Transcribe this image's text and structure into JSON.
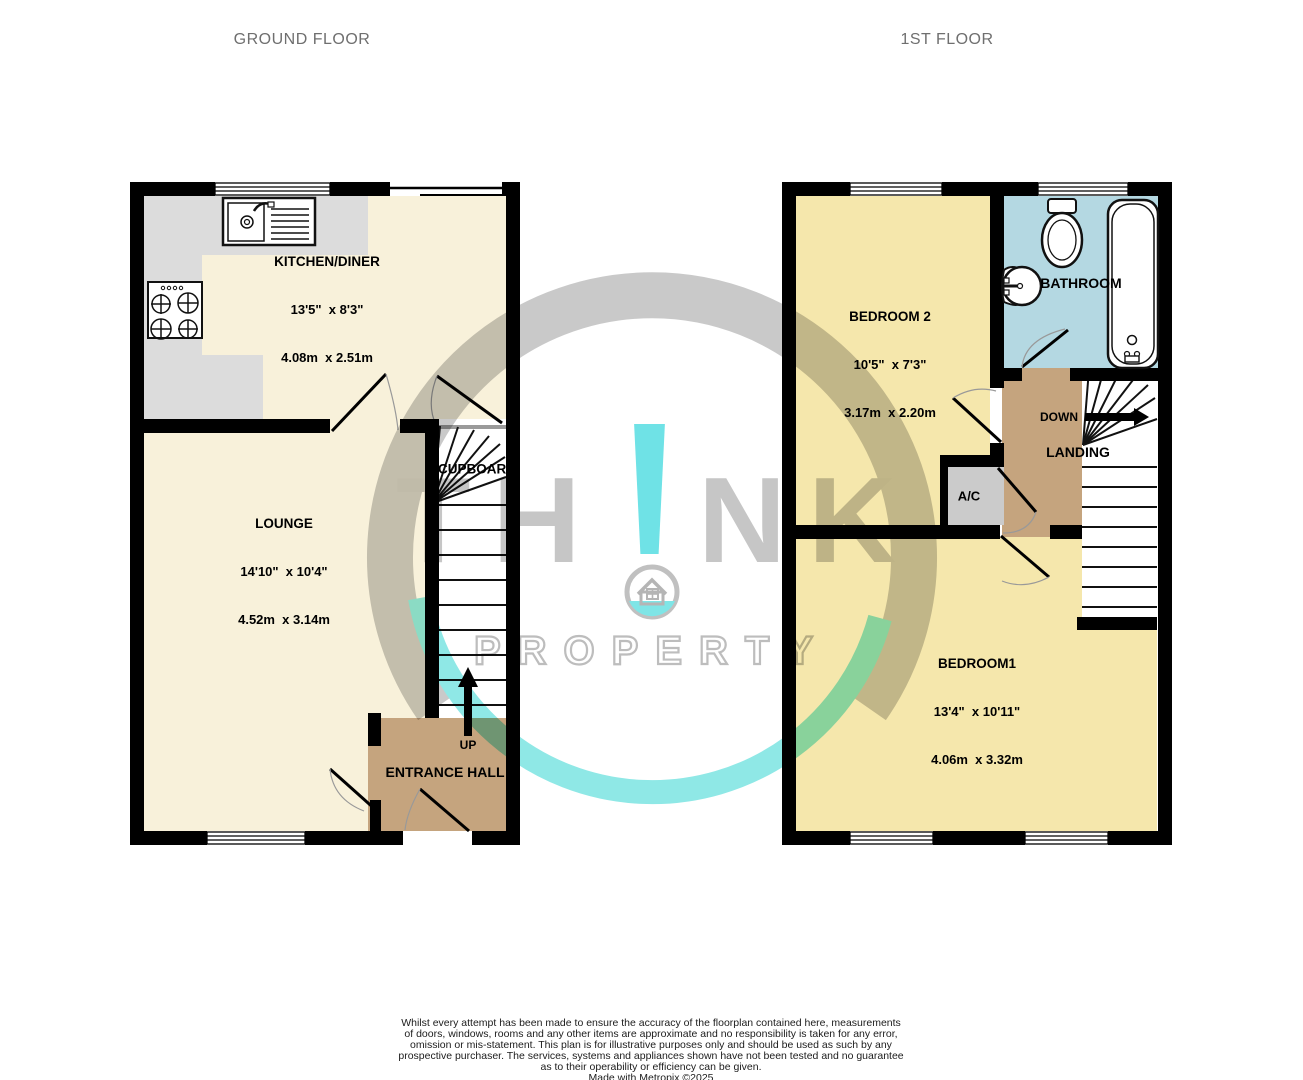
{
  "titles": {
    "ground_floor": "GROUND FLOOR",
    "first_floor": "1ST FLOOR"
  },
  "ground_floor": {
    "kitchen": {
      "name": "KITCHEN/DINER",
      "imperial": "13'5\"  x 8'3\"",
      "metric": "4.08m  x 2.51m"
    },
    "lounge": {
      "name": "LOUNGE",
      "imperial": "14'10\"  x 10'4\"",
      "metric": "4.52m  x 3.14m"
    },
    "cupboard": {
      "name": "CUPBOARD"
    },
    "entrance_hall": {
      "name": "ENTRANCE HALL"
    },
    "stairs_direction": "UP"
  },
  "first_floor": {
    "bedroom2": {
      "name": "BEDROOM 2",
      "imperial": "10'5\"  x 7'3\"",
      "metric": "3.17m  x 2.20m"
    },
    "bathroom": {
      "name": "BATHROOM"
    },
    "bedroom1": {
      "name": "BEDROOM1",
      "imperial": "13'4\"  x 10'11\"",
      "metric": "4.06m  x 3.32m"
    },
    "landing": {
      "name": "LANDING"
    },
    "airing_cupboard": {
      "name": "A/C"
    },
    "stairs_direction": "DOWN"
  },
  "watermark": {
    "brand_left": "TH",
    "brand_bang": "!",
    "brand_right": "NK",
    "brand_line2": "PROPERTY",
    "teal": "#6fe2e6",
    "gray": "#c6c6c6"
  },
  "colors": {
    "ground_room": "#f8f1da",
    "first_room": "#f5e7ac",
    "hall_landing": "#c5a47e",
    "bathroom": "#b4d8e2",
    "counter_gray": "#dcdcdc",
    "ac_gray": "#cbcbcb",
    "wall": "#000000"
  },
  "footer": {
    "lines": [
      "Whilst every attempt has been made to ensure the accuracy of the floorplan contained here, measurements",
      "of doors, windows, rooms and any other items are approximate and no responsibility is taken for any error,",
      "omission or mis-statement. This plan is for illustrative purposes only and should be used as such by any",
      "prospective purchaser. The services, systems and appliances shown have not been tested and no guarantee",
      "as to their operability or efficiency can be given."
    ],
    "credit": "Made with Metropix ©2025"
  }
}
